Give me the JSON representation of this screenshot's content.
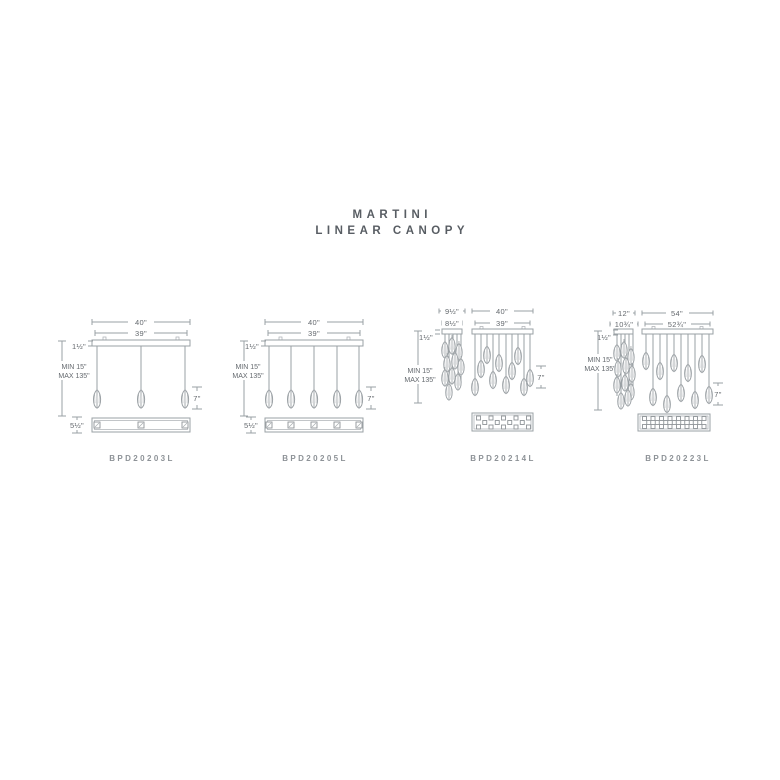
{
  "title": {
    "line1": "MARTINI",
    "line2": "LINEAR CANOPY"
  },
  "colors": {
    "line": "#9aa0a4",
    "dim_text": "#64696e",
    "model_text": "#8d9297",
    "title_text": "#585d63",
    "background": "#ffffff"
  },
  "diagrams": [
    {
      "model": "BPD20203L",
      "pendant_count": 3,
      "dims": {
        "outer_width": "40\"",
        "inner_width": "39\"",
        "canopy_height": "1½\"",
        "suspension_min": "MIN 15\"",
        "suspension_max": "MAX 135\"",
        "pendant_height": "7\"",
        "canopy_depth": "5½\""
      }
    },
    {
      "model": "BPD20205L",
      "pendant_count": 5,
      "dims": {
        "outer_width": "40\"",
        "inner_width": "39\"",
        "canopy_height": "1½\"",
        "suspension_min": "MIN 15\"",
        "suspension_max": "MAX 135\"",
        "pendant_height": "7\"",
        "canopy_depth": "5½\""
      }
    },
    {
      "model": "BPD20214L",
      "pendant_count": 14,
      "dims": {
        "side_outer_width": "9½\"",
        "side_inner_width": "8½\"",
        "outer_width": "40\"",
        "inner_width": "39\"",
        "canopy_height": "1½\"",
        "suspension_min": "MIN 15\"",
        "suspension_max": "MAX 135\"",
        "pendant_height": "7\""
      }
    },
    {
      "model": "BPD20223L",
      "pendant_count": 23,
      "dims": {
        "side_outer_width": "12\"",
        "side_inner_width": "10¾\"",
        "outer_width": "54\"",
        "inner_width": "52¾\"",
        "canopy_height": "1½\"",
        "suspension_min": "MIN 15\"",
        "suspension_max": "MAX 135\"",
        "pendant_height": "7\""
      }
    }
  ]
}
